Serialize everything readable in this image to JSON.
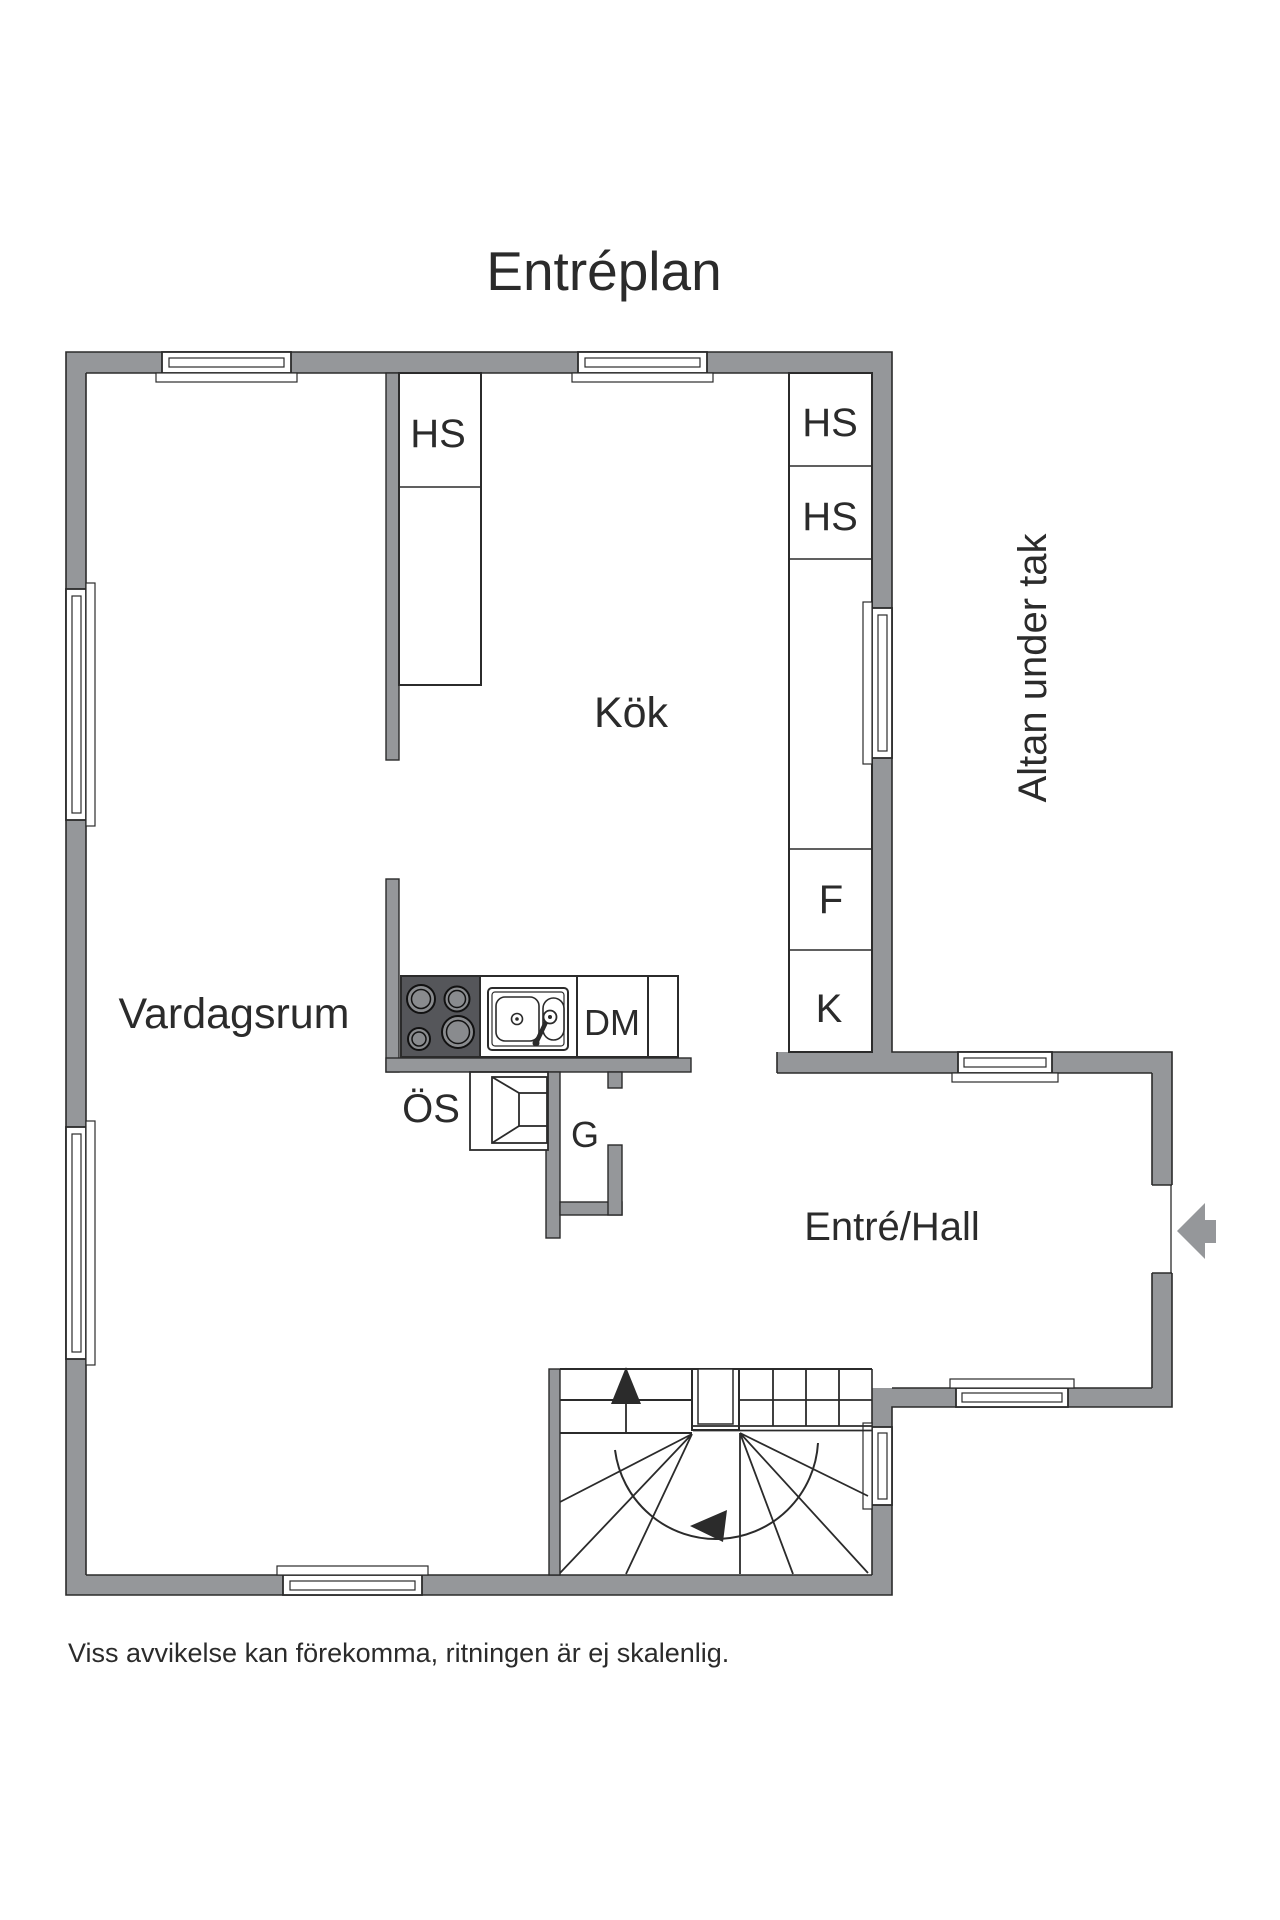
{
  "title": "Entréplan",
  "footer": "Viss avvikelse kan förekomma, ritningen är ej skalenlig.",
  "rooms": {
    "living": "Vardagsrum",
    "kitchen": "Kök",
    "hall": "Entré/Hall",
    "terrace": "Altan under tak"
  },
  "labels": {
    "hs_left": "HS",
    "hs_right_top": "HS",
    "hs_right_mid": "HS",
    "freezer": "F",
    "fridge": "K",
    "dishwasher": "DM",
    "oven": "ÖS",
    "wardrobe": "G"
  },
  "colors": {
    "wall": "#95979A",
    "stove": "#55565A",
    "burner": "#898B8E",
    "line": "#2B2B2B",
    "bg": "#FFFFFF"
  }
}
